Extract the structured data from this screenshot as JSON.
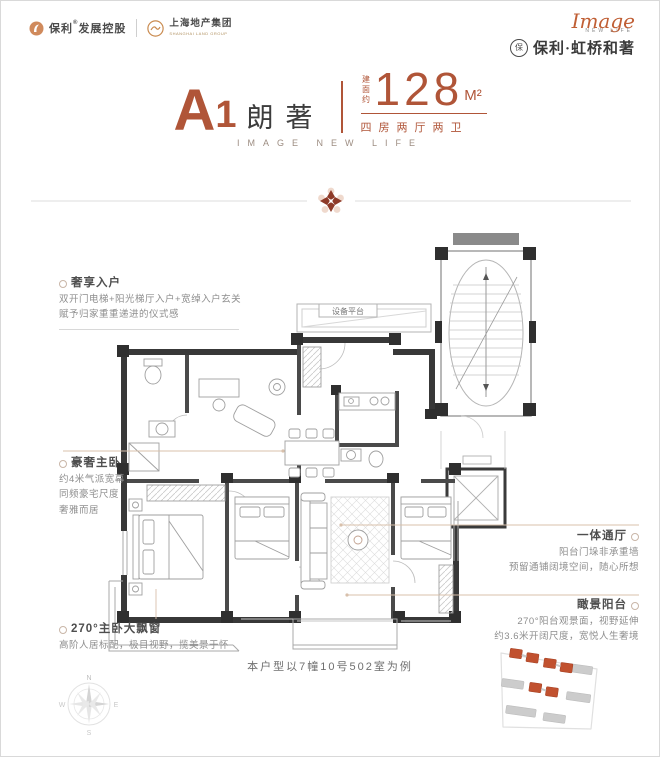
{
  "header": {
    "brand_poly": "保利",
    "brand_poly_reg": "®",
    "brand_poly_rest": "发展控股",
    "brand_shland": "上海地产集团",
    "brand_shland_sub": "SHANGHAI LAND GROUP",
    "logo_script": "Image",
    "logo_script_sub": "NEW LIFE",
    "project_mark": "保",
    "brand_project": "保利·虹桥和著"
  },
  "title": {
    "unit_letter": "A",
    "unit_number": "1",
    "unit_name": "朗著",
    "area_prefix": "建面约",
    "area_value": "128",
    "area_unit": "M²",
    "layout_desc": "四房两厅两卫",
    "subtitle": "IMAGE NEW LIFE"
  },
  "plan": {
    "equipment_platform_label": "设备平台"
  },
  "annotations_left": [
    {
      "title": "奢享入户",
      "lines": [
        "双开门电梯+阳光梯厅入户+宽绰入户玄关",
        "赋予归家重重递进的仪式感"
      ]
    },
    {
      "title": "豪奢主卧",
      "lines": [
        "约4米气派宽幕",
        "同频豪宅尺度",
        "奢雅而居"
      ]
    },
    {
      "title": "270°主卧大飘窗",
      "lines": [
        "高阶人居标配，极目视野，揽美景于怀"
      ]
    }
  ],
  "annotations_right": [
    {
      "title": "一体通厅",
      "lines": [
        "阳台门垛非承重墙",
        "预留通铺阔境空间，随心所想"
      ]
    },
    {
      "title": "瞰景阳台",
      "lines": [
        "270°阳台观景面，视野延伸",
        "约3.6米开阔尺度，宽悦人生奢境"
      ]
    }
  ],
  "footer": {
    "example_note": "本户型以7幢10号502室为例",
    "compass_n": "N",
    "compass_e": "E",
    "compass_s": "S",
    "compass_w": "W"
  },
  "colors": {
    "accent": "#B05538",
    "accent_deep": "#8E3A28",
    "dark_text": "#3D3D3D",
    "gray_text": "#8E8E8E",
    "wall": "#383838",
    "line_light": "#CCCCCC",
    "leader_tan": "#D8C0AB",
    "site_highlight": "#C1512F",
    "site_gray": "#C9C9C9"
  }
}
